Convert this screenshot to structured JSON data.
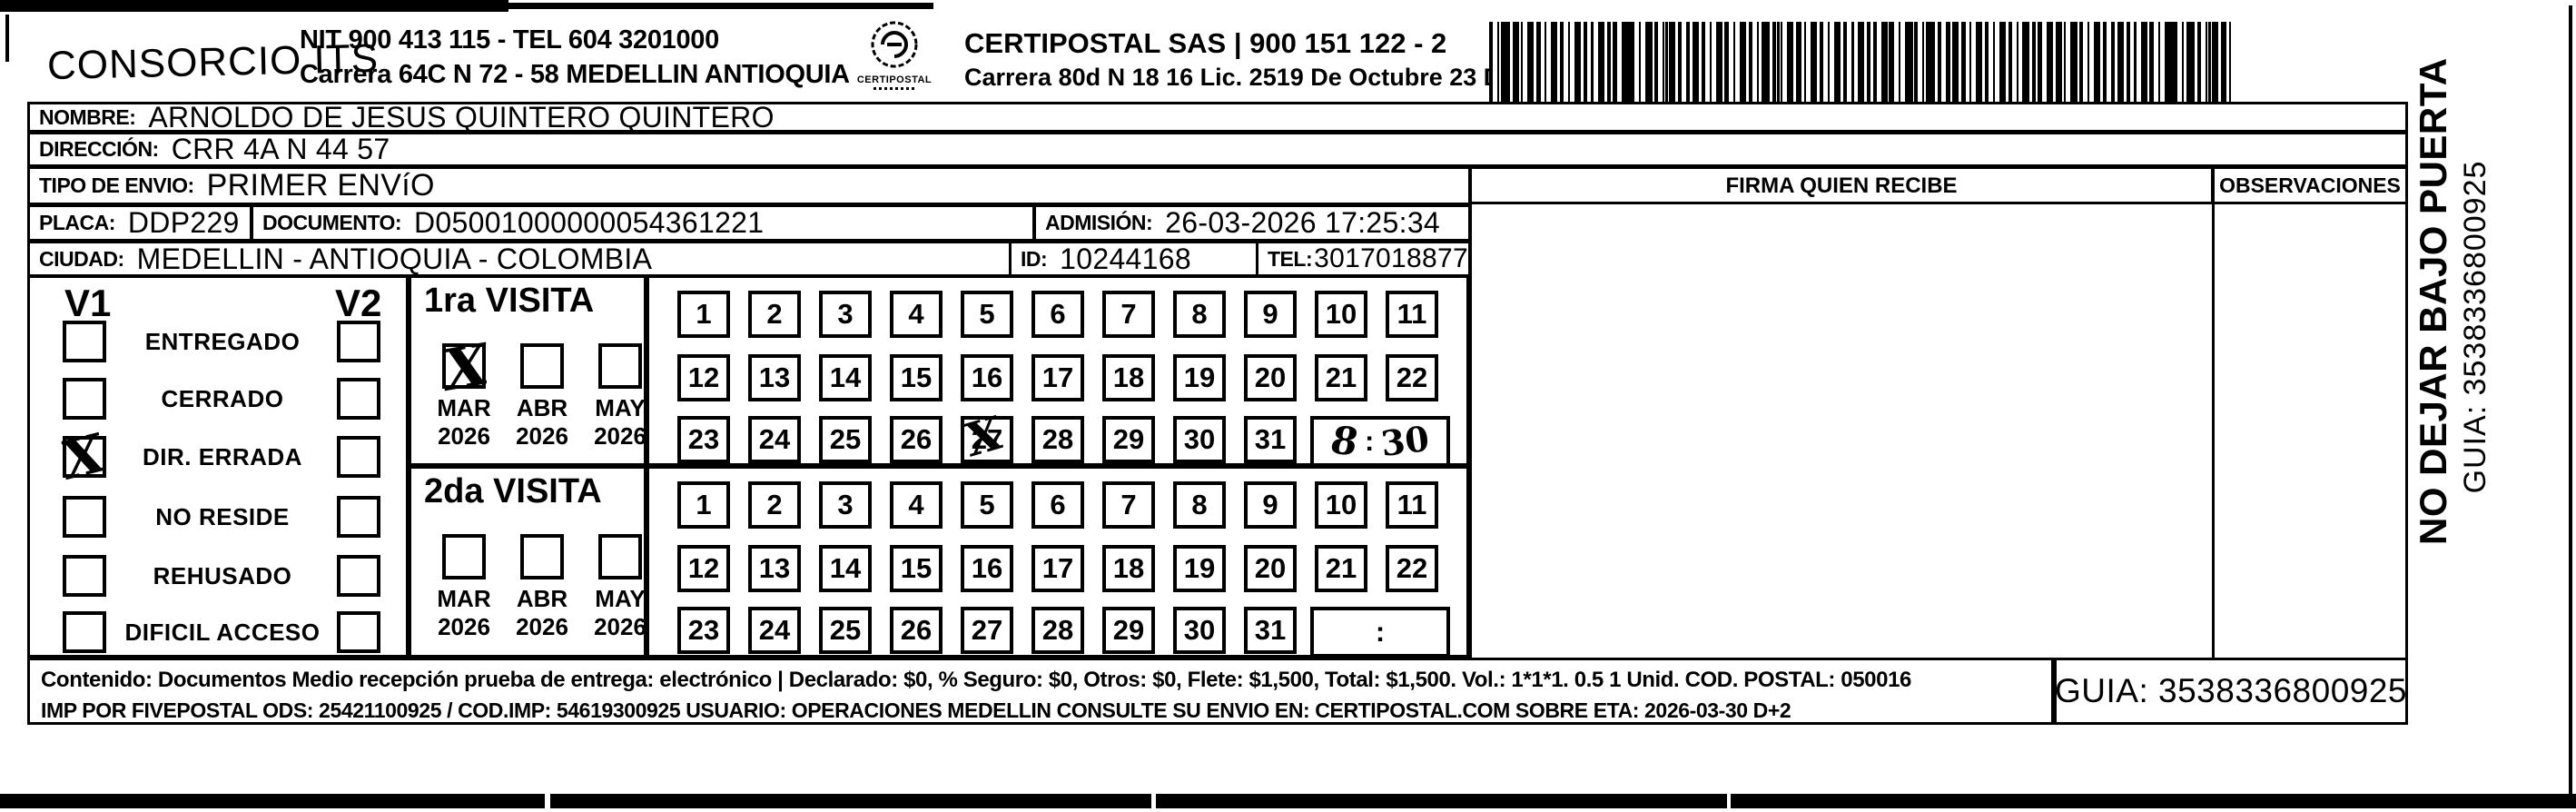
{
  "colors": {
    "ink": "#000000",
    "paper": "#ffffff"
  },
  "icons": {
    "logo": "certipostal-stamp-icon",
    "barcode": "tracking-barcode",
    "bottom_strip": "scan-edge-artifact"
  },
  "header": {
    "company": "CONSORCIO ITS",
    "company_nit": "NIT 900 413 115 - TEL 604 3201000",
    "company_address": "Carrera 64C N 72 - 58 MEDELLIN ANTIOQUIA",
    "logo_caption": "CERTIPOSTAL",
    "operator_line1": "CERTIPOSTAL SAS | 900 151 122 - 2",
    "operator_line2": "Carrera 80d N 18 16  Lic. 2519 De Octubre 23 De 2015"
  },
  "shipment": {
    "nombre_label": "NOMBRE:",
    "nombre": "ARNOLDO DE JESUS QUINTERO QUINTERO",
    "direccion_label": "DIRECCIÓN:",
    "direccion": "CRR 4A N 44 57",
    "tipo_envio_label": "TIPO DE ENVIO:",
    "tipo_envio": "PRIMER ENVíO",
    "placa_label": "PLACA:",
    "placa": "DDP229",
    "documento_label": "DOCUMENTO:",
    "documento": "D05001000000054361221",
    "admision_label": "ADMISIÓN:",
    "admision": "26-03-2026 17:25:34",
    "ciudad_label": "CIUDAD:",
    "ciudad": "MEDELLIN - ANTIOQUIA - COLOMBIA",
    "id_label": "ID:",
    "id": "10244168",
    "tel_label": "TEL:",
    "tel": "3017018877"
  },
  "table_headers": {
    "firma": "FIRMA QUIEN RECIBE",
    "observaciones": "OBSERVACIONES"
  },
  "status_panel": {
    "col1_header": "V1",
    "col2_header": "V2",
    "items": [
      {
        "label": "ENTREGADO",
        "v1_mark": "",
        "v2_mark": ""
      },
      {
        "label": "CERRADO",
        "v1_mark": "",
        "v2_mark": ""
      },
      {
        "label": "DIR. ERRADA",
        "v1_mark": "X",
        "v2_mark": ""
      },
      {
        "label": "NO RESIDE",
        "v1_mark": "",
        "v2_mark": ""
      },
      {
        "label": "REHUSADO",
        "v1_mark": "",
        "v2_mark": ""
      },
      {
        "label": "DIFICIL ACCESO",
        "v1_mark": "",
        "v2_mark": ""
      }
    ]
  },
  "visits": [
    {
      "title": "1ra VISITA",
      "months": [
        {
          "month": "MAR",
          "year": "2026",
          "mark": "X"
        },
        {
          "month": "ABR",
          "year": "2026",
          "mark": ""
        },
        {
          "month": "MAY",
          "year": "2026",
          "mark": ""
        }
      ],
      "days": [
        "1",
        "2",
        "3",
        "4",
        "5",
        "6",
        "7",
        "8",
        "9",
        "10",
        "11",
        "12",
        "13",
        "14",
        "15",
        "16",
        "17",
        "18",
        "19",
        "20",
        "21",
        "22",
        "23",
        "24",
        "25",
        "26",
        "27",
        "28",
        "29",
        "30",
        "31"
      ],
      "crossed_day": "27",
      "crossed_day_mark": "X",
      "time_hour": "8",
      "time_colon": ":",
      "time_minutes": "30"
    },
    {
      "title": "2da VISITA",
      "months": [
        {
          "month": "MAR",
          "year": "2026",
          "mark": ""
        },
        {
          "month": "ABR",
          "year": "2026",
          "mark": ""
        },
        {
          "month": "MAY",
          "year": "2026",
          "mark": ""
        }
      ],
      "days": [
        "1",
        "2",
        "3",
        "4",
        "5",
        "6",
        "7",
        "8",
        "9",
        "10",
        "11",
        "12",
        "13",
        "14",
        "15",
        "16",
        "17",
        "18",
        "19",
        "20",
        "21",
        "22",
        "23",
        "24",
        "25",
        "26",
        "27",
        "28",
        "29",
        "30",
        "31"
      ],
      "crossed_day": "",
      "crossed_day_mark": "",
      "time_hour": "",
      "time_colon": ":",
      "time_minutes": ""
    }
  ],
  "side_note": {
    "line1": "NO DEJAR BAJO PUERTA",
    "line2": "GUIA: 3538336800925"
  },
  "footer": {
    "line1": "Contenido: Documentos Medio recepción prueba de entrega: electrónico | Declarado: $0, % Seguro: $0, Otros: $0, Flete: $1,500, Total: $1,500. Vol.: 1*1*1. 0.5  1 Unid. COD. POSTAL: 050016",
    "line2": "IMP POR FIVEPOSTAL ODS: 25421100925 / COD.IMP: 54619300925 USUARIO: OPERACIONES MEDELLIN CONSULTE SU ENVIO EN: CERTIPOSTAL.COM SOBRE ETA: 2026-03-30 D+2",
    "guia": "GUIA: 3538336800925"
  }
}
